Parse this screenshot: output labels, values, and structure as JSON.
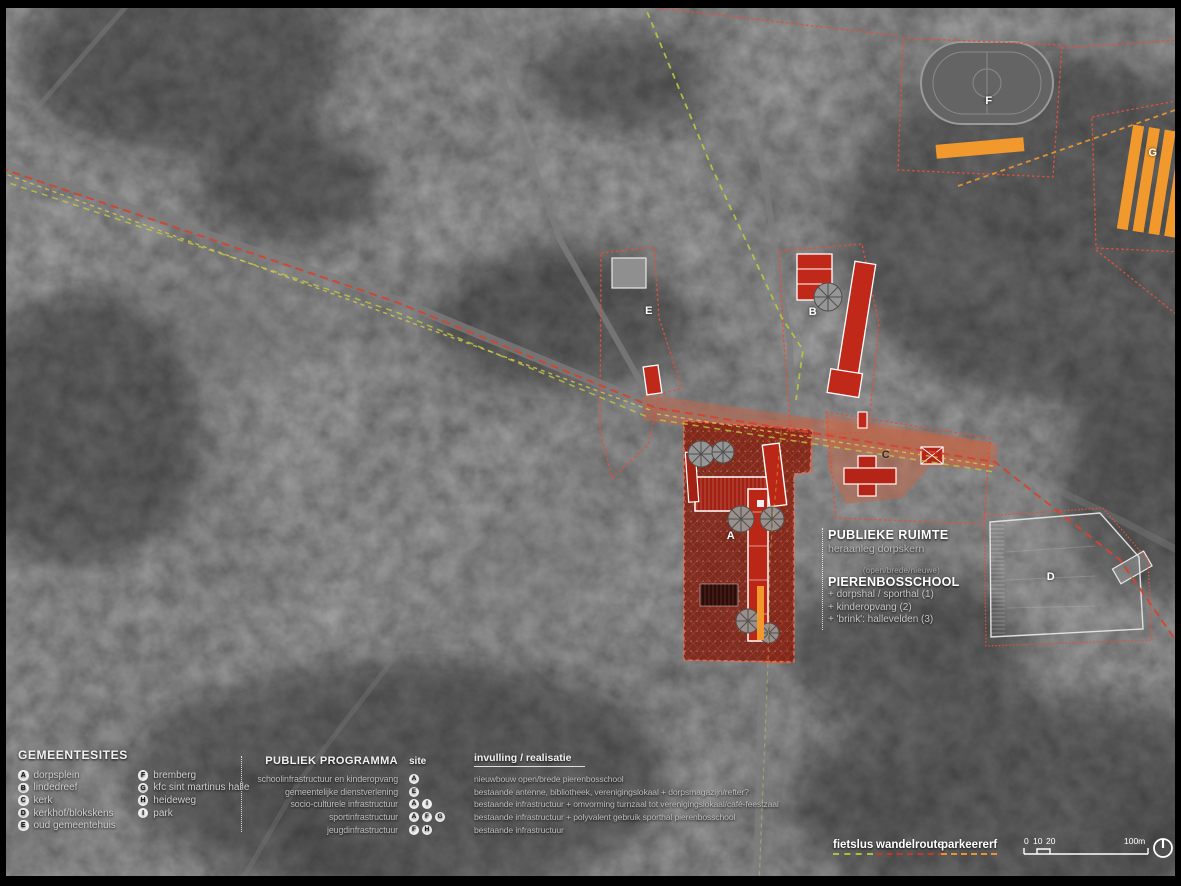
{
  "map": {
    "site_labels": [
      {
        "id": "A"
      },
      {
        "id": "B"
      },
      {
        "id": "C"
      },
      {
        "id": "D"
      },
      {
        "id": "E"
      },
      {
        "id": "F"
      },
      {
        "id": "G"
      }
    ],
    "publieke_ruimte": {
      "title": "PUBLIEKE RUIMTE",
      "subtitle": "heraanleg dorpskern"
    },
    "pierenbosschool": {
      "pre": "(open/brede/nieuwe)",
      "title": "PIERENBOSSCHOOL",
      "items": [
        "+ dorpshal / sporthal (1)",
        "+ kinderopvang (2)",
        "+ 'brink': hallevelden (3)"
      ]
    }
  },
  "gemeentesites": {
    "title": "GEMEENTESITES",
    "col1": [
      {
        "badge": "A",
        "label": "dorpsplein"
      },
      {
        "badge": "B",
        "label": "lindedreef"
      },
      {
        "badge": "C",
        "label": "kerk"
      },
      {
        "badge": "D",
        "label": "kerkhof/blokskens"
      },
      {
        "badge": "E",
        "label": "oud gemeentehuis"
      }
    ],
    "col2": [
      {
        "badge": "F",
        "label": "bremberg"
      },
      {
        "badge": "G",
        "label": "kfc sint martinus halle"
      },
      {
        "badge": "H",
        "label": "heideweg"
      },
      {
        "badge": "I",
        "label": "park"
      }
    ]
  },
  "programma": {
    "title": "PUBLIEK PROGRAMMA",
    "site_header": "site",
    "realisatie_header": "invulling / realisatie",
    "rows": [
      {
        "label": "schoolinfrastructuur en kinderopvang",
        "sites": [
          "A"
        ],
        "realisatie": "nieuwbouw open/brede pierenbosschool"
      },
      {
        "label": "gemeentelijke dienstverlening",
        "sites": [
          "E"
        ],
        "realisatie": "bestaande antenne, bibliotheek, verenigingslokaal + dorpsmagazijn/refter?"
      },
      {
        "label": "socio-culturele infrastructuur",
        "sites": [
          "A",
          "I"
        ],
        "realisatie": "bestaande infrastructuur + omvorming turnzaal tot verenigingslokaal/café-feestzaal"
      },
      {
        "label": "sportinfrastructuur",
        "sites": [
          "A",
          "F",
          "G"
        ],
        "realisatie": "bestaande infrastructuur + polyvalent gebruik sporthal pierenbosschool"
      },
      {
        "label": "jeugdinfrastructuur",
        "sites": [
          "F",
          "H"
        ],
        "realisatie": "bestaande infrastructuur"
      }
    ]
  },
  "routes": [
    {
      "label": "fietslus",
      "color": "#aebf3a"
    },
    {
      "label": "wandelroute",
      "color": "#c0392b"
    },
    {
      "label": "parkeererf",
      "color": "#e8952f"
    }
  ],
  "scalebar": {
    "t0": "0",
    "t10": "10",
    "t20": "20",
    "end": "100m"
  },
  "colors": {
    "zone_red": "#7f1e10",
    "building_red": "#c0281a",
    "public_space_salmon": "#c97a5a",
    "parking_orange": "#f2992e",
    "route_green": "#b8c93e",
    "route_red": "#d24431",
    "route_yellow": "#d9c84e",
    "route_orange": "#e8952f"
  }
}
